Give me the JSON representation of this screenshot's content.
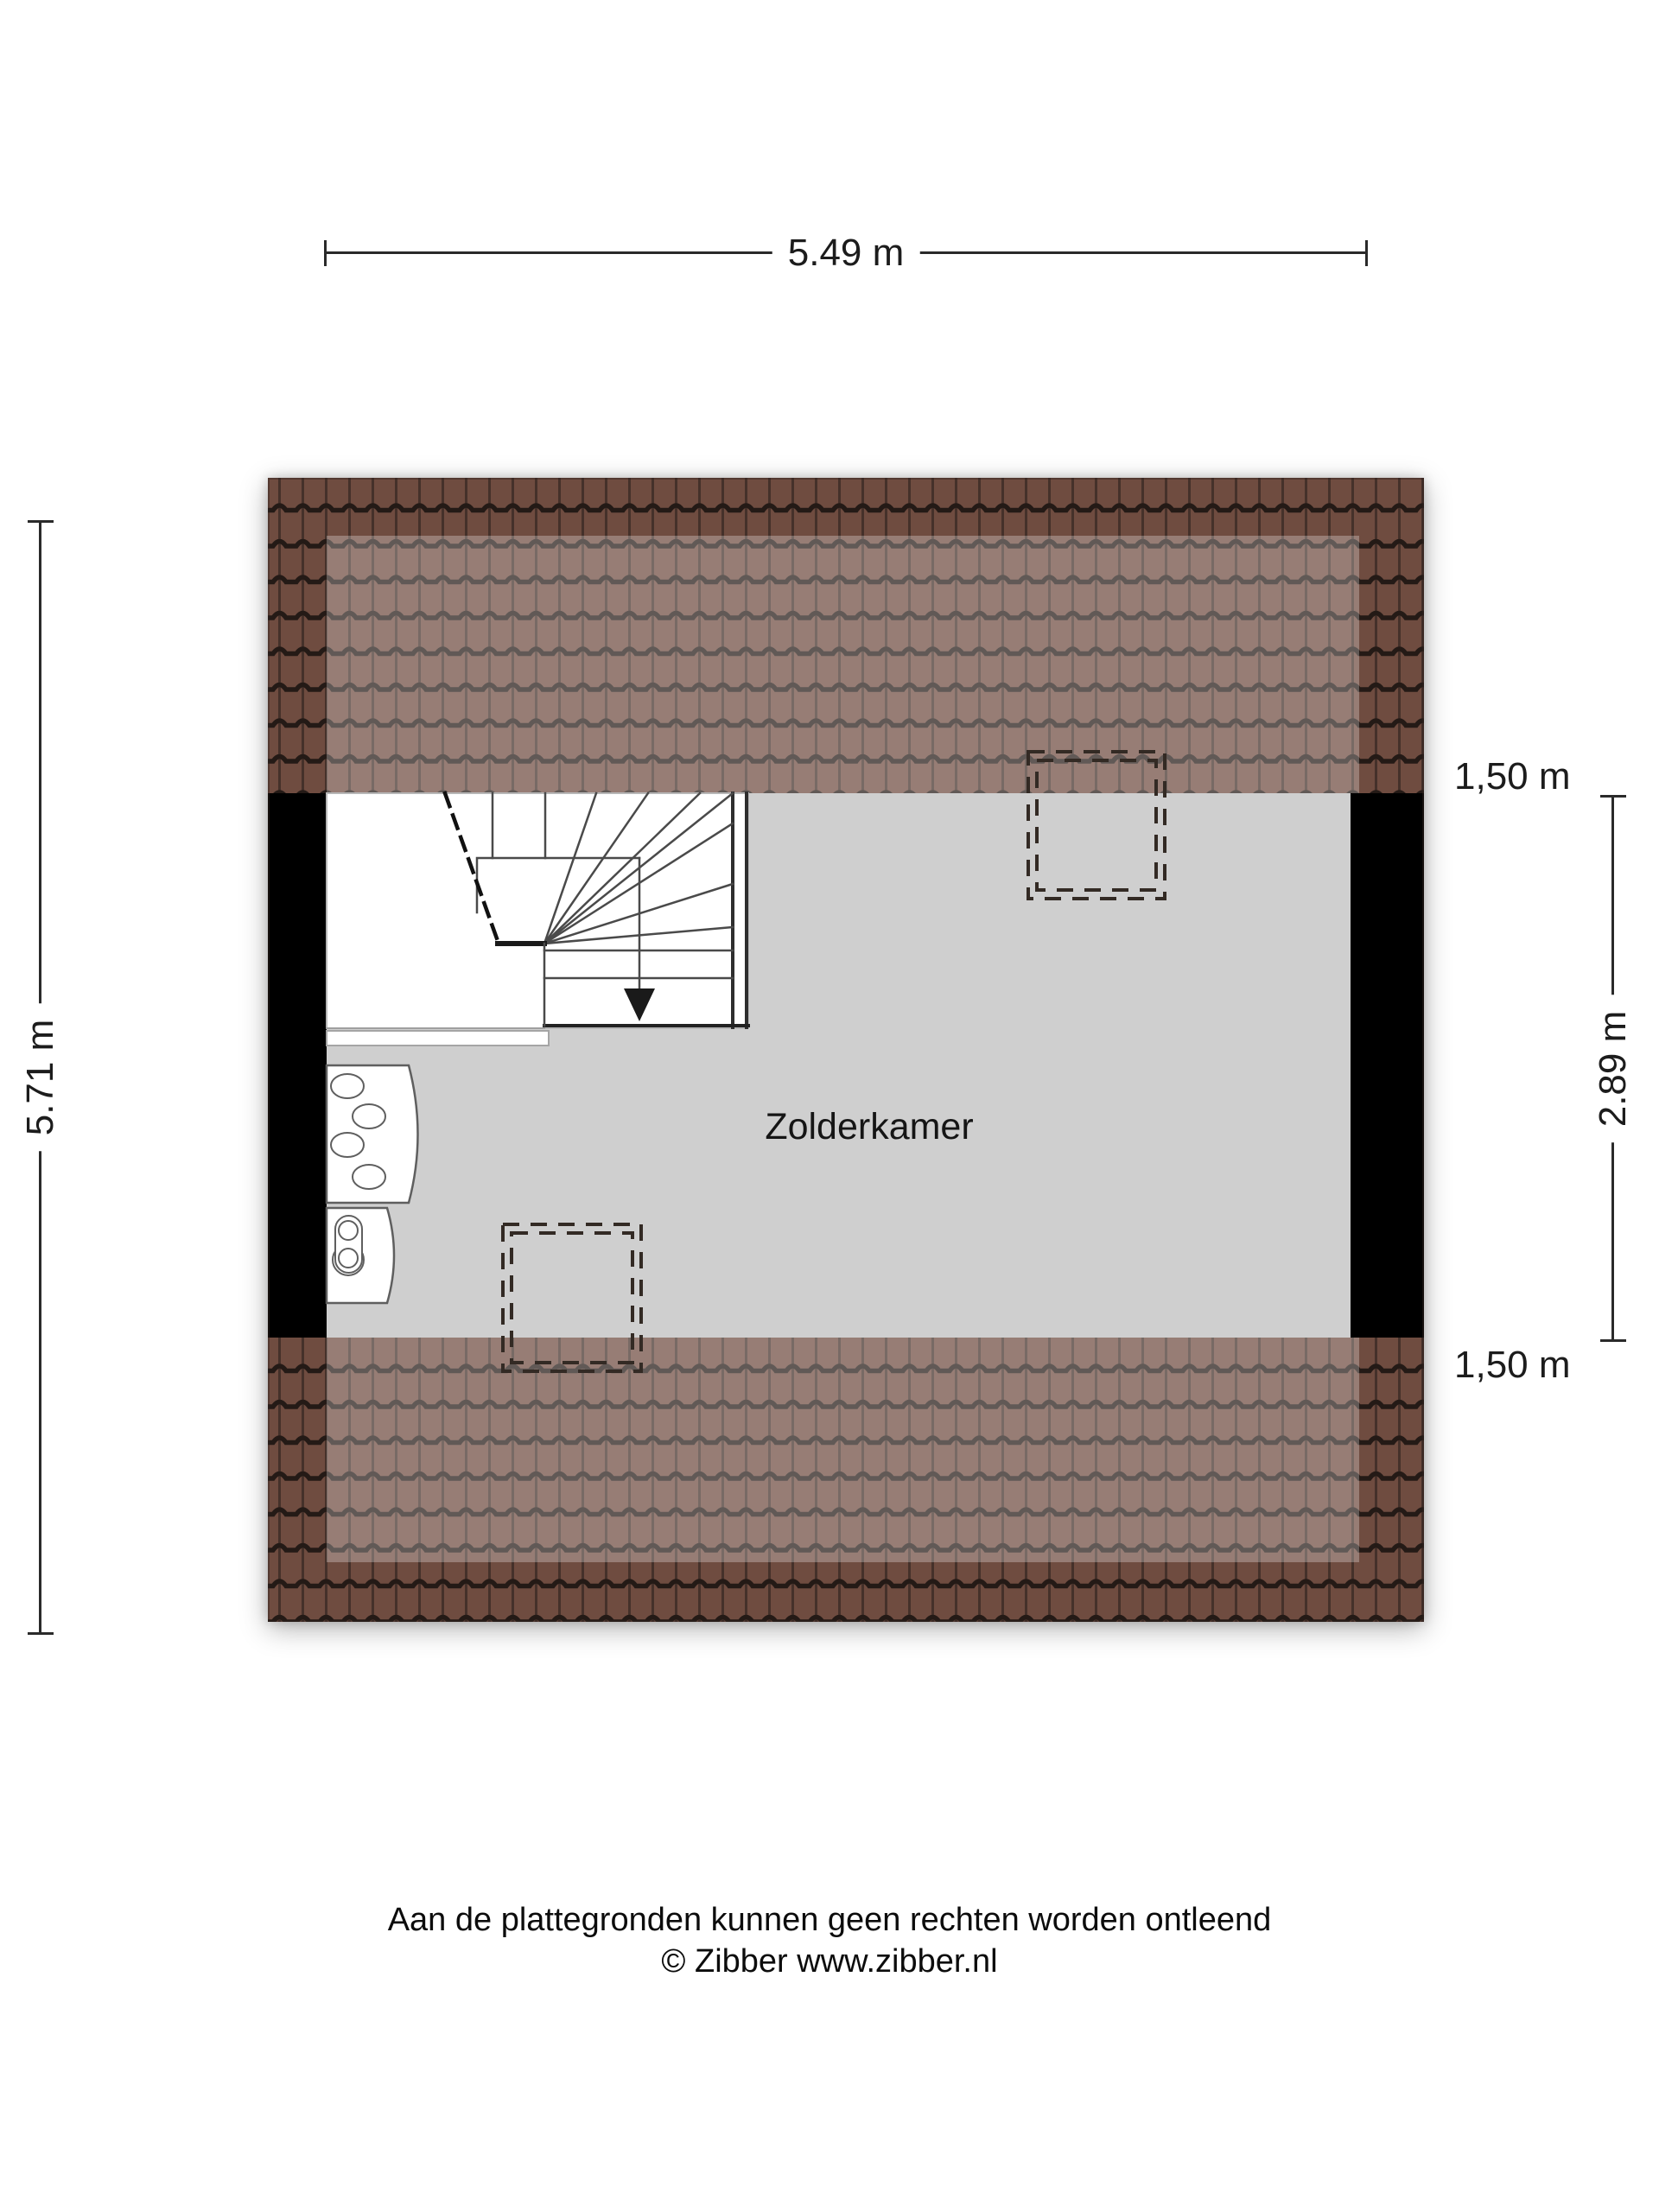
{
  "page": {
    "disclaimer": "Aan de plattegronden kunnen geen rechten worden ontleend",
    "copyright": "© Zibber www.zibber.nl"
  },
  "plan": {
    "room_label": "Zolderkamer",
    "floor_name": "Zolder"
  },
  "dimensions": {
    "total_width": "5.49 m",
    "total_height": "5.71 m",
    "right_height": "2.89 m",
    "knee_wall_top": "1,50 m",
    "knee_wall_bottom": "1,50 m"
  },
  "colors": {
    "page_bg": "#ffffff",
    "roof_base": "#6f4c40",
    "roof_seam": "#241a16",
    "roof_rib": "#45312a",
    "roof_highlight": "#ffffff",
    "room_fill": "#cfcfcf",
    "wall_fill": "#000000",
    "stair_fill": "#ffffff",
    "stair_line": "#4a4a4a",
    "dash_color": "#332a24",
    "dim_color": "#2a2a2a"
  }
}
